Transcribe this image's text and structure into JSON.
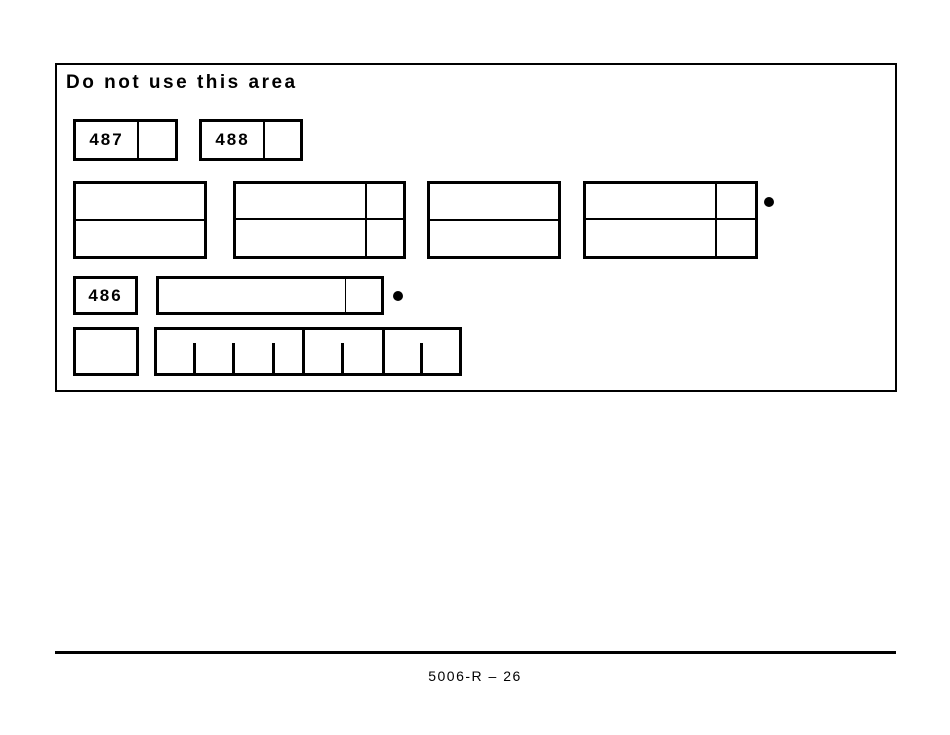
{
  "do_not_use_area": {
    "title": "Do not use this area",
    "code_box_1": {
      "code": "487"
    },
    "code_box_2": {
      "code": "488"
    },
    "code_box_3": {
      "code": "486"
    }
  },
  "footer": {
    "page_label": "5006-R – 26"
  },
  "colors": {
    "ink": "#000000",
    "background": "#ffffff"
  }
}
